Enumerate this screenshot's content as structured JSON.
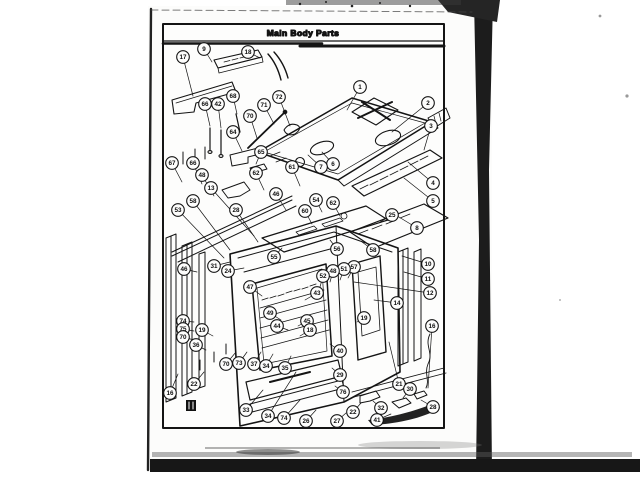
{
  "page": {
    "title": "Main Body Parts"
  },
  "colors": {
    "ink": "#141414",
    "paper": "#fcfcfb",
    "band": "#1a1a1a"
  },
  "callouts": [
    {
      "n": "9",
      "x": 204,
      "y": 49,
      "tx": 212,
      "ty": 62
    },
    {
      "n": "17",
      "x": 183,
      "y": 57,
      "tx": 193,
      "ty": 96
    },
    {
      "n": "18",
      "x": 248,
      "y": 52,
      "tx": 260,
      "ty": 58
    },
    {
      "n": "72",
      "x": 279,
      "y": 97,
      "tx": 290,
      "ty": 126
    },
    {
      "n": "71",
      "x": 264,
      "y": 105,
      "tx": 274,
      "ty": 124
    },
    {
      "n": "68",
      "x": 233,
      "y": 96,
      "tx": 237,
      "ty": 114
    },
    {
      "n": "70",
      "x": 250,
      "y": 116,
      "tx": 257,
      "ty": 138
    },
    {
      "n": "66",
      "x": 205,
      "y": 104,
      "tx": 210,
      "ty": 126
    },
    {
      "n": "42",
      "x": 218,
      "y": 104,
      "tx": 221,
      "ty": 128
    },
    {
      "n": "64",
      "x": 233,
      "y": 132,
      "tx": 242,
      "ty": 151
    },
    {
      "n": "65",
      "x": 261,
      "y": 152,
      "tx": 256,
      "ty": 164
    },
    {
      "n": "1",
      "x": 360,
      "y": 87,
      "tx": 347,
      "ty": 110
    },
    {
      "n": "2",
      "x": 428,
      "y": 103,
      "tx": 392,
      "ty": 132
    },
    {
      "n": "3",
      "x": 431,
      "y": 126,
      "tx": 424,
      "ty": 150
    },
    {
      "n": "67",
      "x": 172,
      "y": 163,
      "tx": 182,
      "ty": 182
    },
    {
      "n": "66",
      "x": 193,
      "y": 163,
      "tx": 202,
      "ty": 184
    },
    {
      "n": "48",
      "x": 202,
      "y": 175,
      "tx": 214,
      "ty": 196
    },
    {
      "n": "13",
      "x": 211,
      "y": 188,
      "tx": 254,
      "ty": 236
    },
    {
      "n": "58",
      "x": 193,
      "y": 201,
      "tx": 230,
      "ty": 250
    },
    {
      "n": "53",
      "x": 178,
      "y": 210,
      "tx": 224,
      "ty": 258
    },
    {
      "n": "28",
      "x": 236,
      "y": 210,
      "tx": 258,
      "ty": 242
    },
    {
      "n": "62",
      "x": 256,
      "y": 173,
      "tx": 264,
      "ty": 190
    },
    {
      "n": "61",
      "x": 292,
      "y": 167,
      "tx": 300,
      "ty": 186
    },
    {
      "n": "46",
      "x": 276,
      "y": 194,
      "tx": 286,
      "ty": 210
    },
    {
      "n": "60",
      "x": 305,
      "y": 211,
      "tx": 312,
      "ty": 224
    },
    {
      "n": "6",
      "x": 333,
      "y": 164,
      "tx": 322,
      "ty": 152
    },
    {
      "n": "7",
      "x": 321,
      "y": 167,
      "tx": 308,
      "ty": 155
    },
    {
      "n": "62",
      "x": 333,
      "y": 203,
      "tx": 340,
      "ty": 216
    },
    {
      "n": "54",
      "x": 316,
      "y": 200,
      "tx": 322,
      "ty": 212
    },
    {
      "n": "4",
      "x": 433,
      "y": 183,
      "tx": 408,
      "ty": 162
    },
    {
      "n": "5",
      "x": 433,
      "y": 201,
      "tx": 404,
      "ty": 178
    },
    {
      "n": "25",
      "x": 392,
      "y": 215,
      "tx": 380,
      "ty": 222
    },
    {
      "n": "8",
      "x": 417,
      "y": 228,
      "tx": 394,
      "ty": 214
    },
    {
      "n": "56",
      "x": 337,
      "y": 249,
      "tx": 330,
      "ty": 240
    },
    {
      "n": "58",
      "x": 373,
      "y": 250,
      "tx": 362,
      "ty": 242
    },
    {
      "n": "55",
      "x": 274,
      "y": 257,
      "tx": 282,
      "ty": 248
    },
    {
      "n": "57",
      "x": 354,
      "y": 267,
      "tx": 348,
      "ty": 278
    },
    {
      "n": "51",
      "x": 344,
      "y": 269,
      "tx": 340,
      "ty": 280
    },
    {
      "n": "48",
      "x": 333,
      "y": 271,
      "tx": 330,
      "ty": 282
    },
    {
      "n": "52",
      "x": 323,
      "y": 276,
      "tx": 320,
      "ty": 287
    },
    {
      "n": "46",
      "x": 184,
      "y": 269,
      "tx": 197,
      "ty": 272
    },
    {
      "n": "31",
      "x": 214,
      "y": 266,
      "tx": 230,
      "ty": 262
    },
    {
      "n": "24",
      "x": 228,
      "y": 271,
      "tx": 244,
      "ty": 268
    },
    {
      "n": "47",
      "x": 250,
      "y": 287,
      "tx": 262,
      "ty": 296
    },
    {
      "n": "43",
      "x": 317,
      "y": 293,
      "tx": 305,
      "ty": 300
    },
    {
      "n": "49",
      "x": 270,
      "y": 313,
      "tx": 281,
      "ty": 320
    },
    {
      "n": "44",
      "x": 277,
      "y": 326,
      "tx": 288,
      "ty": 330
    },
    {
      "n": "45",
      "x": 307,
      "y": 321,
      "tx": 298,
      "ty": 326
    },
    {
      "n": "18",
      "x": 310,
      "y": 330,
      "tx": 300,
      "ty": 336
    },
    {
      "n": "19",
      "x": 202,
      "y": 330,
      "tx": 213,
      "ty": 336
    },
    {
      "n": "74",
      "x": 183,
      "y": 321,
      "tx": 194,
      "ty": 322
    },
    {
      "n": "75",
      "x": 183,
      "y": 329,
      "tx": 194,
      "ty": 331
    },
    {
      "n": "70",
      "x": 183,
      "y": 337,
      "tx": 194,
      "ty": 340
    },
    {
      "n": "36",
      "x": 196,
      "y": 345,
      "tx": 206,
      "ty": 350
    },
    {
      "n": "14",
      "x": 397,
      "y": 303,
      "tx": 374,
      "ty": 300
    },
    {
      "n": "19",
      "x": 364,
      "y": 318,
      "tx": 357,
      "ty": 322
    },
    {
      "n": "10",
      "x": 428,
      "y": 264,
      "tx": 402,
      "ty": 256
    },
    {
      "n": "11",
      "x": 428,
      "y": 279,
      "tx": 404,
      "ty": 272
    },
    {
      "n": "12",
      "x": 430,
      "y": 293,
      "tx": 354,
      "ty": 282
    },
    {
      "n": "16",
      "x": 432,
      "y": 326,
      "tx": 428,
      "ty": 388
    },
    {
      "n": "16",
      "x": 170,
      "y": 393,
      "tx": 178,
      "ty": 374
    },
    {
      "n": "22",
      "x": 194,
      "y": 384,
      "tx": 204,
      "ty": 372
    },
    {
      "n": "70",
      "x": 226,
      "y": 364,
      "tx": 236,
      "ty": 352
    },
    {
      "n": "73",
      "x": 239,
      "y": 363,
      "tx": 247,
      "ty": 352
    },
    {
      "n": "37",
      "x": 254,
      "y": 364,
      "tx": 261,
      "ty": 352
    },
    {
      "n": "34",
      "x": 266,
      "y": 366,
      "tx": 273,
      "ty": 354
    },
    {
      "n": "35",
      "x": 285,
      "y": 368,
      "tx": 291,
      "ty": 356
    },
    {
      "n": "40",
      "x": 340,
      "y": 351,
      "tx": 330,
      "ty": 344
    },
    {
      "n": "29",
      "x": 340,
      "y": 375,
      "tx": 332,
      "ty": 368
    },
    {
      "n": "76",
      "x": 343,
      "y": 392,
      "tx": 335,
      "ty": 386
    },
    {
      "n": "33",
      "x": 246,
      "y": 410,
      "tx": 263,
      "ty": 390
    },
    {
      "n": "34",
      "x": 268,
      "y": 416,
      "tx": 296,
      "ty": 372
    },
    {
      "n": "74",
      "x": 284,
      "y": 418,
      "tx": 300,
      "ty": 400
    },
    {
      "n": "26",
      "x": 306,
      "y": 421,
      "tx": 316,
      "ty": 410
    },
    {
      "n": "27",
      "x": 337,
      "y": 421,
      "tx": 346,
      "ty": 413
    },
    {
      "n": "22",
      "x": 353,
      "y": 412,
      "tx": 361,
      "ty": 403
    },
    {
      "n": "32",
      "x": 381,
      "y": 408,
      "tx": 373,
      "ty": 401
    },
    {
      "n": "41",
      "x": 377,
      "y": 420,
      "tx": 391,
      "ty": 414
    },
    {
      "n": "21",
      "x": 399,
      "y": 384,
      "tx": 389,
      "ty": 342
    },
    {
      "n": "30",
      "x": 410,
      "y": 389,
      "tx": 403,
      "ty": 398
    },
    {
      "n": "28",
      "x": 433,
      "y": 407,
      "tx": 421,
      "ty": 400
    }
  ]
}
